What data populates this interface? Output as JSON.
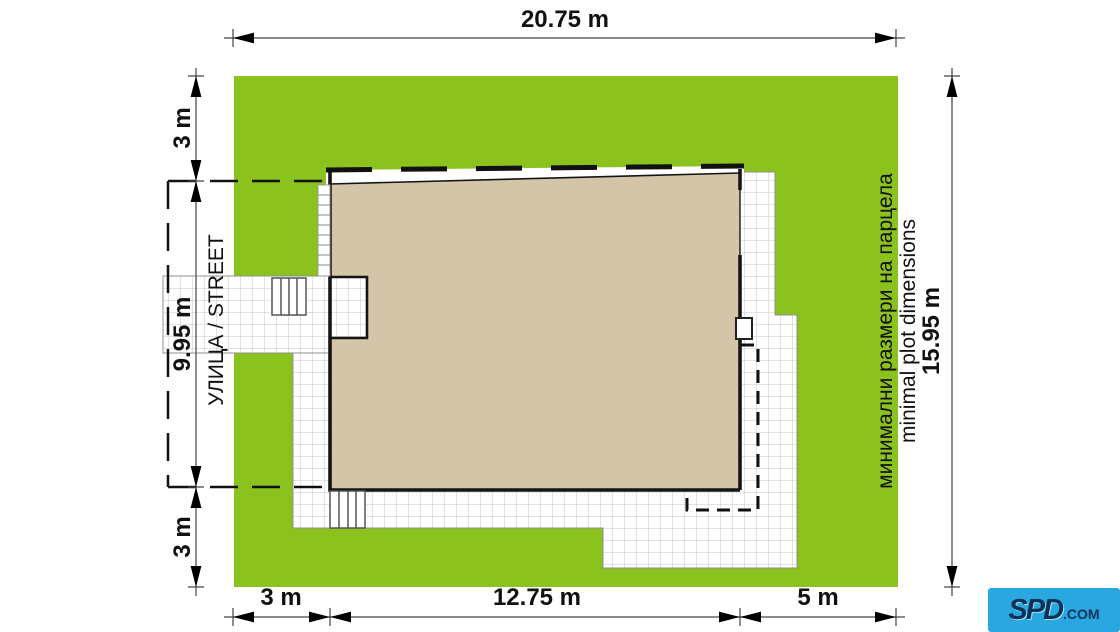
{
  "plan": {
    "dimensions": {
      "top_width": "20.75 m",
      "left_top_setback": "3 m",
      "left_house_depth": "9.95 m",
      "left_bottom_setback": "3 m",
      "right_height": "15.95 m",
      "bottom_left_offset": "3 m",
      "bottom_house_width": "12.75 m",
      "bottom_right_offset": "5 m"
    },
    "labels": {
      "street": "УЛИЦА / STREET",
      "plot_note_bg": "минимални размери на парцела",
      "plot_note_en": "minimal plot dimensions"
    },
    "colors": {
      "grass": "#8cc21e",
      "house": "#d4c5a8",
      "logo_blue": "#29a7e0"
    },
    "logo": {
      "text": "SPD",
      "suffix": ".COM"
    }
  }
}
